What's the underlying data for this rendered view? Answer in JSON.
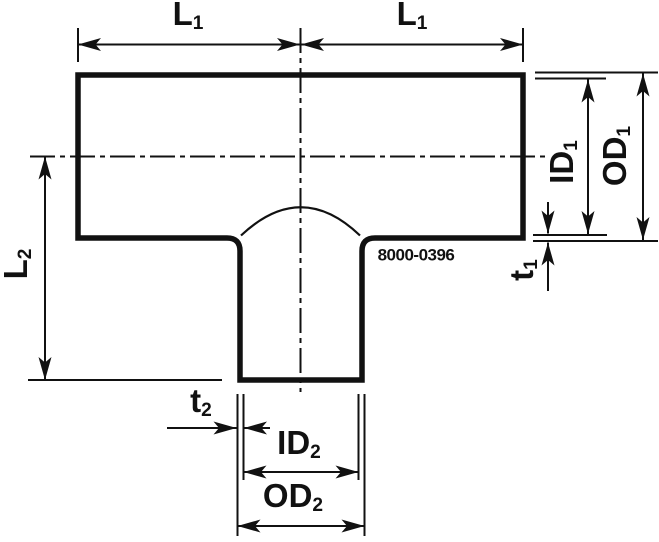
{
  "drawing": {
    "part_number": "8000-0396",
    "colors": {
      "line": "#111111",
      "background": "#ffffff"
    },
    "labels": {
      "l1_left": {
        "main": "L",
        "sub": "1"
      },
      "l1_right": {
        "main": "L",
        "sub": "1"
      },
      "l2": {
        "main": "L",
        "sub": "2"
      },
      "id1": {
        "main": "ID",
        "sub": "1"
      },
      "od1": {
        "main": "OD",
        "sub": "1"
      },
      "t1": {
        "main": "t",
        "sub": "1"
      },
      "t2": {
        "main": "t",
        "sub": "2"
      },
      "id2": {
        "main": "ID",
        "sub": "2"
      },
      "od2": {
        "main": "OD",
        "sub": "2"
      }
    }
  }
}
